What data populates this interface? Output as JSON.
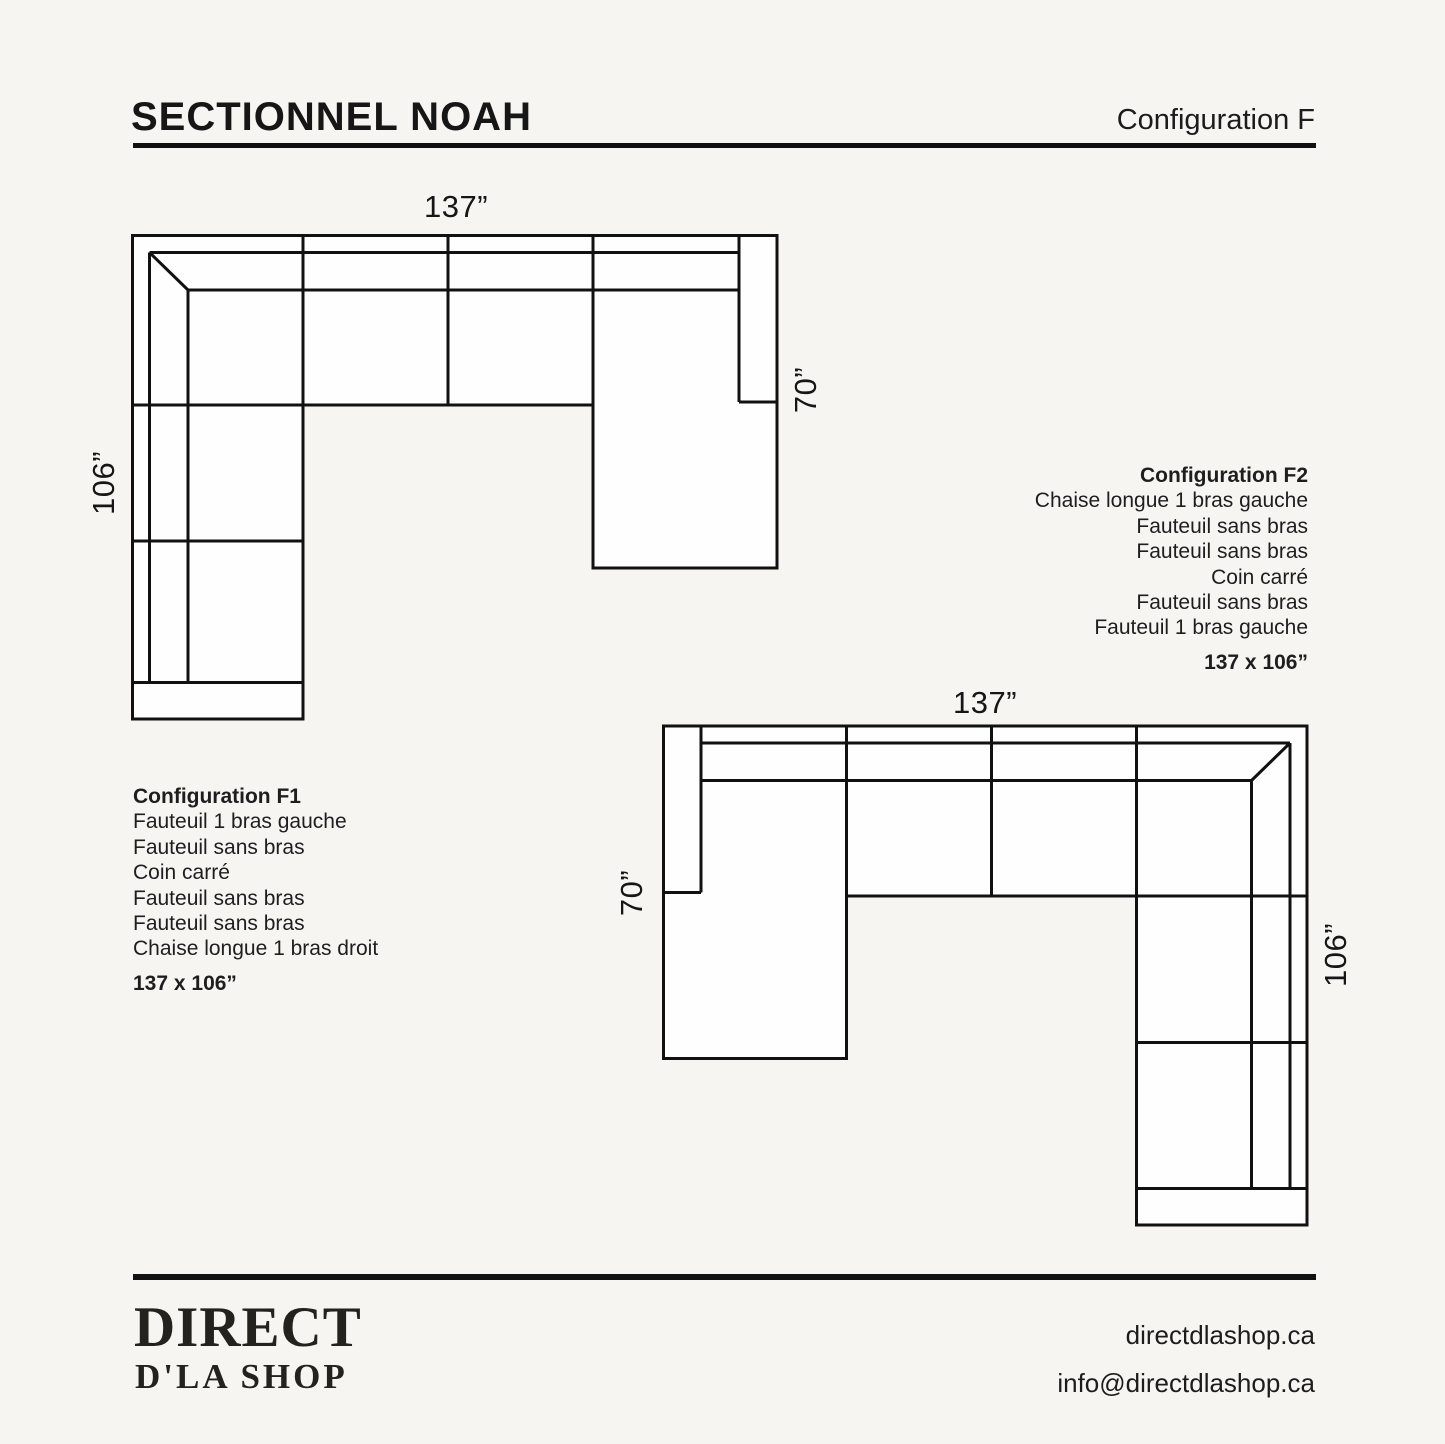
{
  "colors": {
    "background": "#f6f5f2",
    "line": "#111111",
    "sofa_fill": "#fefefe",
    "ink": "#1c1c1c"
  },
  "header": {
    "title": "SECTIONNEL NOAH",
    "configuration": "Configuration F"
  },
  "diagrams": {
    "f1": {
      "width_label": "137”",
      "left_label": "106”",
      "right_label": "70”"
    },
    "f2": {
      "width_label": "137”",
      "left_label": "70”",
      "right_label": "106”"
    }
  },
  "configurations": [
    {
      "name": "Configuration F1",
      "modules": [
        "Fauteuil 1 bras gauche",
        "Fauteuil sans bras",
        "Coin carré",
        "Fauteuil sans bras",
        "Fauteuil sans bras",
        "Chaise longue 1 bras droit"
      ],
      "dimensions": "137 x 106”"
    },
    {
      "name": "Configuration F2",
      "modules": [
        "Chaise longue 1 bras gauche",
        "Fauteuil sans bras",
        "Fauteuil sans bras",
        "Coin carré",
        "Fauteuil sans bras",
        "Fauteuil 1 bras gauche"
      ],
      "dimensions": "137 x 106”"
    }
  ],
  "footer": {
    "logo_line1": "DIRECT",
    "logo_line2": "D'LA SHOP",
    "website": "directdlashop.ca",
    "email": "info@directdlashop.ca"
  }
}
